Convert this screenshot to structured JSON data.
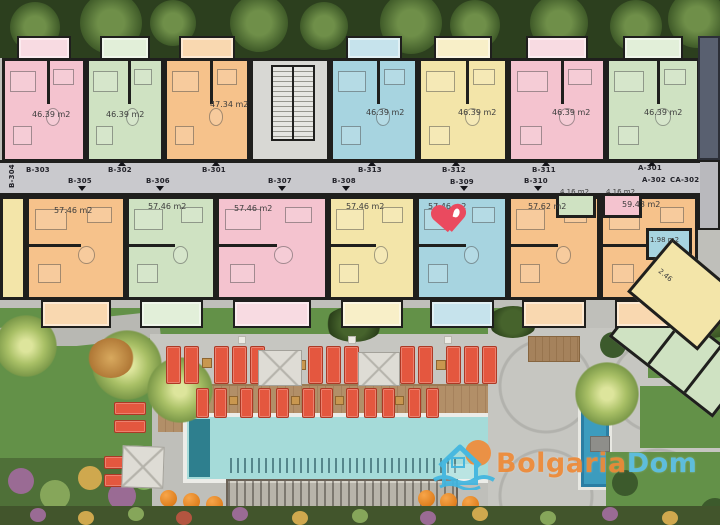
{
  "watermark": {
    "brand_part1": "Bolgaria",
    "brand_part2": "Dom",
    "color_part1": "#ee8a38",
    "color_part2": "#5ec1e8",
    "logo": "house-sun-waves-icon"
  },
  "plan": {
    "corridor_labels": [
      "B-304",
      "B-303",
      "B-305",
      "B-302",
      "B-306",
      "B-301",
      "B-307",
      "B-308",
      "B-313",
      "B-312",
      "B-309",
      "B-311",
      "B-310",
      "A-301",
      "A-302",
      "CA-302"
    ],
    "top_units": [
      {
        "area": "46.39 m2",
        "color": "pink"
      },
      {
        "area": "46.39 m2",
        "color": "green"
      },
      {
        "area": "47.34 m2",
        "color": "orange"
      },
      {
        "area": "",
        "color": "stairs"
      },
      {
        "area": "46.39 m2",
        "color": "blue"
      },
      {
        "area": "46.39 m2",
        "color": "yellow"
      },
      {
        "area": "46.39 m2",
        "color": "pink"
      },
      {
        "area": "46.39 m2",
        "color": "green"
      }
    ],
    "bottom_units": [
      {
        "area": "",
        "color": "yellow"
      },
      {
        "area": "57.46 m2",
        "color": "orange"
      },
      {
        "area": "57.46 m2",
        "color": "green"
      },
      {
        "area": "57.46 m2",
        "color": "pink"
      },
      {
        "area": "57.46 m2",
        "color": "yellow"
      },
      {
        "area": "57.46 m2",
        "color": "blue",
        "favorite": true
      },
      {
        "area": "57.62 m2",
        "color": "orange"
      },
      {
        "area": "59.43 m2",
        "color": "orange"
      }
    ],
    "small_rooms": [
      {
        "area": "4.16 m2",
        "color": "green"
      },
      {
        "area": "4.16 m2",
        "color": "pink"
      },
      {
        "area": "1.98 m2",
        "color": "blue"
      },
      {
        "area": "2.46",
        "color": "yellow"
      }
    ],
    "unit_colors": {
      "pink": "#f4c3cf",
      "green": "#cfe2c2",
      "orange": "#f6c28b",
      "blue": "#a7d4e0",
      "yellow": "#f3e5a9",
      "stairs": "#d8d8d4"
    },
    "unit_colors_light": {
      "pink": "#f8dbe2",
      "green": "#e2efd9",
      "orange": "#f9d8b0",
      "blue": "#c6e3ec",
      "yellow": "#f8efc8",
      "stairs": "#e2e2de"
    },
    "favorite_icon": "heart-icon"
  }
}
